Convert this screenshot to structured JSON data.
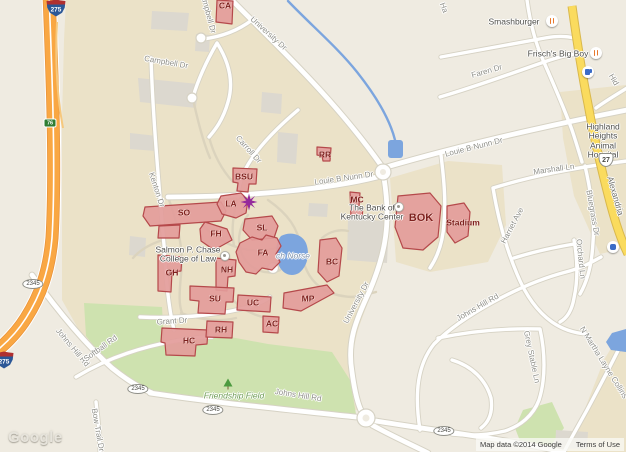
{
  "map": {
    "logo": "Google",
    "attribution": {
      "map_data": "Map data ©2014 Google",
      "terms": "Terms of Use"
    },
    "colors": {
      "campus": "#EBE2C8",
      "outside": "#EFEBE1",
      "park_green": "#CEE2AF",
      "building_fill": "#E39C9A",
      "building_stroke": "#B5494B",
      "building_label": "#7E211E",
      "freeway_orange": "#F9A743",
      "freeway_edge": "#E8933B",
      "highway_yellow": "#FADB5E",
      "highway_edge": "#D9B84C",
      "water": "#7CA5DE",
      "road_casing": "#D6D2C4",
      "gray_bldg": "#DCD8CF",
      "minor_path": "#DBD3BD",
      "road_label": "#8F8F88",
      "poi_label": "#4E4E49",
      "park_label": "#6E9C54",
      "water_label": "#8295AC",
      "star_purple": "#952A9C",
      "restaurant_orange": "#E8782C",
      "gas_blue": "#3B6CC7",
      "interstate_blue": "#2B5797",
      "interstate_red": "#B03030",
      "exit_green": "#2E7D32"
    },
    "road_labels": [
      {
        "t": "University Dr",
        "x": 268,
        "y": 34,
        "r": 42
      },
      {
        "t": "Campbell Dr",
        "x": 207,
        "y": 12,
        "r": 75
      },
      {
        "t": "Campbell Dr",
        "x": 166,
        "y": 63,
        "r": 10
      },
      {
        "t": "Carroll Dr",
        "x": 248,
        "y": 150,
        "r": 48
      },
      {
        "t": "Kenton Dr",
        "x": 156,
        "y": 190,
        "r": 72
      },
      {
        "t": "Louie B Nunn Dr",
        "x": 344,
        "y": 179,
        "r": -8
      },
      {
        "t": "Louie B Nunn Dr",
        "x": 474,
        "y": 148,
        "r": -14
      },
      {
        "t": "University Dr",
        "x": 357,
        "y": 303,
        "r": -62
      },
      {
        "t": "Grant Dr",
        "x": 172,
        "y": 322,
        "r": -4
      },
      {
        "t": "Johns Hill Rd",
        "x": 72,
        "y": 348,
        "r": 50
      },
      {
        "t": "Softball Rd",
        "x": 101,
        "y": 349,
        "r": -36
      },
      {
        "t": "Bow Trail Dr",
        "x": 97,
        "y": 430,
        "r": 80
      },
      {
        "t": "Johns Hill Rd",
        "x": 298,
        "y": 396,
        "r": 9
      },
      {
        "t": "Johns Hill Rd",
        "x": 478,
        "y": 308,
        "r": -30
      },
      {
        "t": "Faren Dr",
        "x": 487,
        "y": 72,
        "r": -16
      },
      {
        "t": "Marshall Ln",
        "x": 554,
        "y": 170,
        "r": -8
      },
      {
        "t": "Harriet Ave",
        "x": 513,
        "y": 226,
        "r": -62
      },
      {
        "t": "Bluegrass Dr",
        "x": 592,
        "y": 213,
        "r": 80
      },
      {
        "t": "Orchard Ln",
        "x": 580,
        "y": 259,
        "r": 84
      },
      {
        "t": "Grey Stable Ln",
        "x": 531,
        "y": 357,
        "r": 78
      },
      {
        "t": "N Martha Layne Collins",
        "x": 603,
        "y": 363,
        "r": 58
      },
      {
        "t": "Alexandria",
        "x": 615,
        "y": 196,
        "r": 74,
        "cls": "hwy"
      },
      {
        "t": "Hid",
        "x": 613,
        "y": 80,
        "r": 60
      },
      {
        "t": "Ha",
        "x": 443,
        "y": 8,
        "r": 70
      }
    ],
    "poi_labels": [
      {
        "t": "Smashburger",
        "x": 514,
        "y": 22
      },
      {
        "t": "Frisch's Big Boy",
        "x": 558,
        "y": 54
      },
      {
        "t": "The Bank of\nKentucky Center",
        "x": 372,
        "y": 213
      },
      {
        "t": "Salmon P. Chase\nCollege of Law",
        "x": 188,
        "y": 255
      },
      {
        "t": "Highland Heights\nAnimal Hospital",
        "x": 603,
        "y": 141
      }
    ],
    "park_labels": [
      {
        "t": "Friendship Field",
        "x": 234,
        "y": 396
      }
    ],
    "water_labels": [
      {
        "t": "ch Norse",
        "x": 293,
        "y": 256
      }
    ],
    "building_labels": [
      {
        "t": "CA",
        "x": 225,
        "y": 6
      },
      {
        "t": "BSU",
        "x": 244,
        "y": 177
      },
      {
        "t": "RR",
        "x": 325,
        "y": 155
      },
      {
        "t": "SO",
        "x": 184,
        "y": 213
      },
      {
        "t": "LA",
        "x": 231,
        "y": 204
      },
      {
        "t": "FH",
        "x": 216,
        "y": 234
      },
      {
        "t": "SL",
        "x": 262,
        "y": 228
      },
      {
        "t": "FA",
        "x": 263,
        "y": 253
      },
      {
        "t": "NH",
        "x": 227,
        "y": 270
      },
      {
        "t": "GH",
        "x": 172,
        "y": 273
      },
      {
        "t": "MC",
        "x": 357,
        "y": 200
      },
      {
        "t": "SU",
        "x": 215,
        "y": 299
      },
      {
        "t": "UC",
        "x": 253,
        "y": 303
      },
      {
        "t": "MP",
        "x": 308,
        "y": 299
      },
      {
        "t": "BC",
        "x": 332,
        "y": 262
      },
      {
        "t": "AC",
        "x": 272,
        "y": 324
      },
      {
        "t": "HC",
        "x": 189,
        "y": 341
      },
      {
        "t": "RH",
        "x": 221,
        "y": 330
      },
      {
        "t": "BOK",
        "x": 421,
        "y": 218,
        "cls": "big"
      },
      {
        "t": "Stadium",
        "x": 463,
        "y": 223
      }
    ],
    "shields": [
      {
        "type": "interstate",
        "text": "275",
        "x": 56,
        "y": 8
      },
      {
        "type": "interstate",
        "text": "275",
        "x": 4,
        "y": 360
      },
      {
        "type": "exit",
        "text": "76",
        "x": 50,
        "y": 123
      },
      {
        "type": "us",
        "text": "27",
        "x": 606,
        "y": 160
      },
      {
        "type": "oval",
        "text": "2345",
        "x": 33,
        "y": 284
      },
      {
        "type": "oval",
        "text": "2345",
        "x": 138,
        "y": 389
      },
      {
        "type": "oval",
        "text": "2345",
        "x": 213,
        "y": 410
      },
      {
        "type": "oval",
        "text": "2345",
        "x": 444,
        "y": 431
      }
    ],
    "icons": [
      {
        "type": "restaurant",
        "x": 552,
        "y": 21
      },
      {
        "type": "restaurant",
        "x": 596,
        "y": 53
      },
      {
        "type": "gas",
        "x": 588,
        "y": 72
      },
      {
        "type": "poi",
        "x": 613,
        "y": 247
      },
      {
        "type": "tree",
        "x": 228,
        "y": 384,
        "inter": false
      },
      {
        "type": "dot",
        "x": 225,
        "y": 256
      },
      {
        "type": "dot",
        "x": 399,
        "y": 207
      },
      {
        "type": "star",
        "x": 249,
        "y": 202
      }
    ]
  }
}
